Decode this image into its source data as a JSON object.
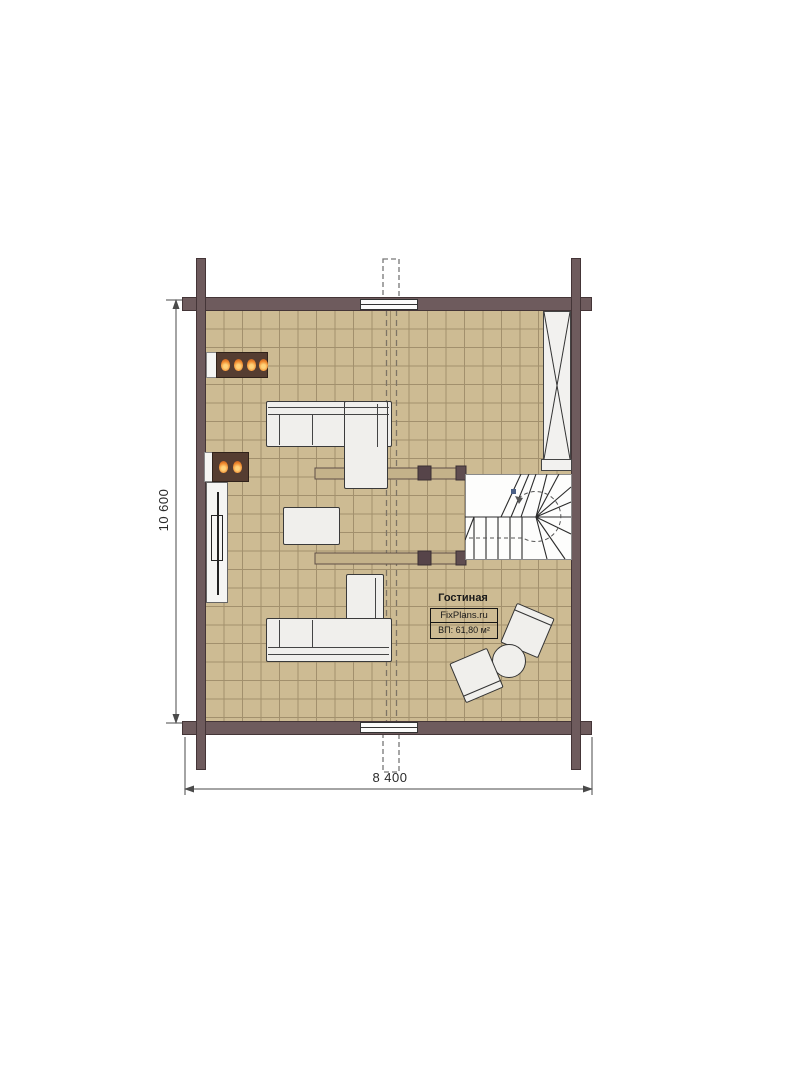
{
  "label": {
    "room_name": "Гостиная",
    "brand": "FixPlans.ru",
    "area": "ВП: 61,80 м²"
  },
  "dimensions": {
    "vertical": "10 600",
    "horizontal": "8 400"
  },
  "colors": {
    "wall": "#6e5b5d",
    "floor": "#cdbb93",
    "grid": "#a2906d",
    "furniture": "#f0efec",
    "outline": "#3a3a3a",
    "fireplace": "#553d31",
    "flame": "#f08a2e",
    "beam": "#c4b28a",
    "post": "#564449",
    "dashed": "#7d7465"
  },
  "furniture": [
    "corner-sofa-top",
    "corner-sofa-bottom",
    "coffee-table",
    "tv-unit",
    "fireplace-large",
    "fireplace-small",
    "wardrobe",
    "winder-staircase",
    "armchair",
    "armchair",
    "round-side-table"
  ]
}
